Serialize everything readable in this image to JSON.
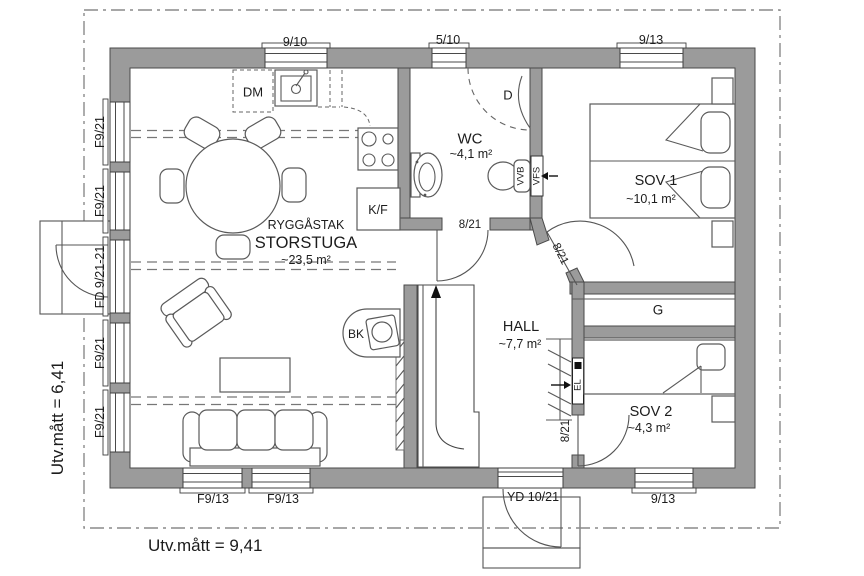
{
  "dimensions": {
    "width_label": "Utv.mått = 9,41",
    "height_label": "Utv.mått = 6,41"
  },
  "rooms": {
    "storstuga": {
      "ridge": "RYGGÅSTAK",
      "name": "STORSTUGA",
      "area": "~23,5 m²"
    },
    "wc": {
      "name": "WC",
      "area": "~4,1 m²"
    },
    "sov1": {
      "name": "SOV 1",
      "area": "~10,1 m²"
    },
    "hall": {
      "name": "HALL",
      "area": "~7,7 m²"
    },
    "sov2": {
      "name": "SOV 2",
      "area": "~4,3 m²"
    },
    "closet": {
      "name": "G"
    }
  },
  "openings": {
    "top_window_1": "9/10",
    "top_window_2": "5/10",
    "top_window_3": "9/13",
    "left_window_1": "F9/21",
    "left_window_2": "F9/21",
    "left_door": "FD 9/21-21",
    "left_window_3": "F9/21",
    "left_window_4": "F9/21",
    "bottom_window_1": "F9/13",
    "bottom_window_2": "F9/13",
    "entry_door": "YD 10/21",
    "bottom_window_3": "9/13",
    "wc_door": "8/21",
    "sov1_door": "8/21",
    "sov2_door": "8/21"
  },
  "fixtures": {
    "dishwasher": "DM",
    "fridge_freezer": "K/F",
    "wood_stove": "BK",
    "shower": "D",
    "water_heater": "VVB",
    "ventilation": "VFS",
    "electrical": "EL"
  },
  "colors": {
    "wall": "#9b9b9b",
    "line": "#4a4a4a",
    "text": "#1c1c1c"
  }
}
